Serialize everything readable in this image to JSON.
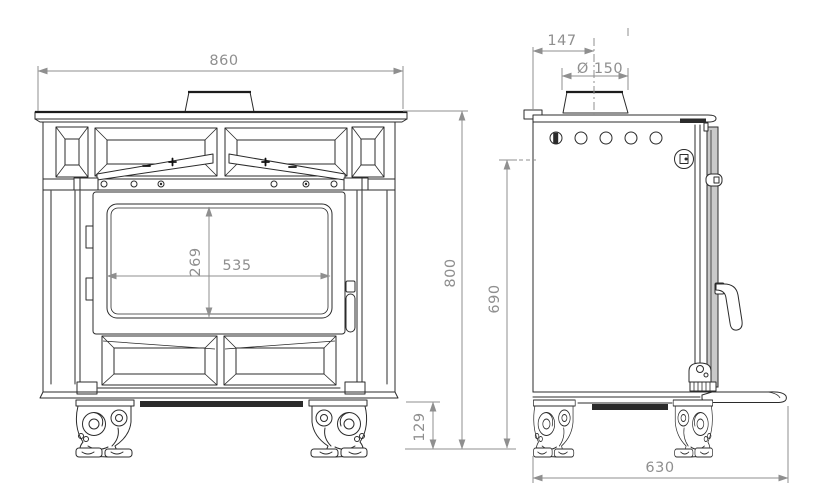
{
  "drawing": {
    "kind": "stove dimensional drawing, front and side elevations",
    "colors": {
      "background": "#ffffff",
      "outline": "#2b2b2b",
      "dimension": "#8f8f8f",
      "door_edge_shade": "#c9c9c9"
    }
  },
  "dims": {
    "front_width": "860",
    "front_height": "800",
    "glass_width": "535",
    "glass_height": "269",
    "leg_height": "129",
    "flue_offset": "147",
    "flue_diameter": "Ø 150",
    "outlet_height": "690",
    "depth": "630"
  }
}
